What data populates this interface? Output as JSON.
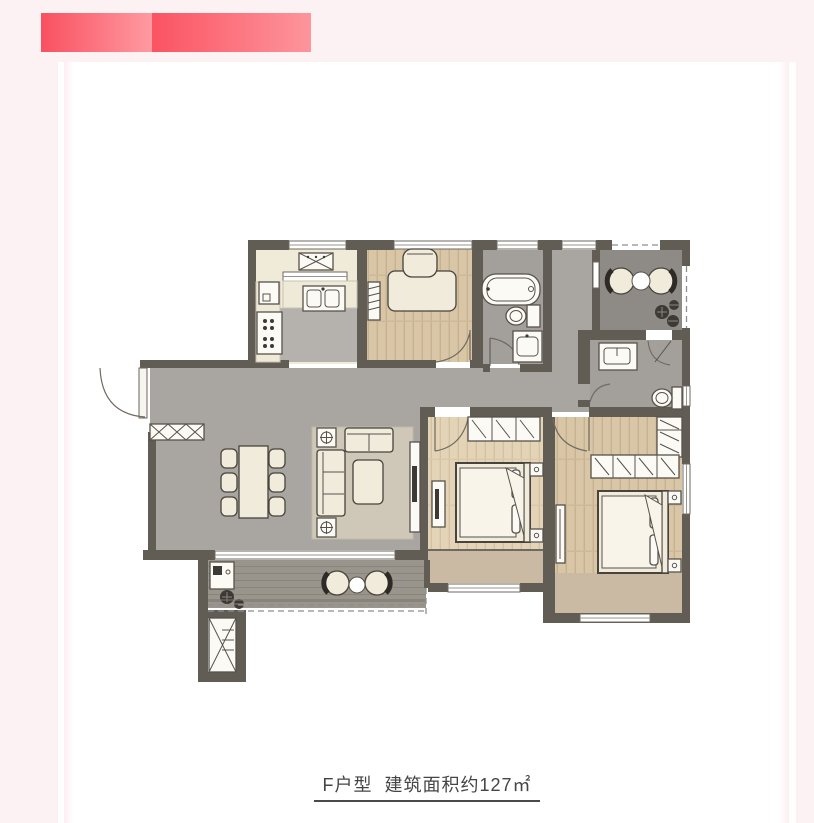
{
  "page": {
    "background": "#fdf2f3",
    "card_background": "#ffffff"
  },
  "header_bars": {
    "bar1": {
      "gradient_start": "#fa5060",
      "gradient_end": "#fe9aa1"
    },
    "bar2": {
      "gradient_start": "#fb5362",
      "gradient_end": "#fd959c"
    }
  },
  "floorplan": {
    "caption": "F户型  建筑面积约127㎡",
    "unit_label": "F户型",
    "area_label": "建筑面积约127㎡",
    "palette": {
      "wall": "#615c54",
      "tile": "#a9a6a2",
      "bath": "#a3a09c",
      "terrace": "#8e8b86",
      "balcony": "#99948c",
      "sill": "#cbbaa3",
      "furn": "#f1ebdc",
      "furnst": "#48433c",
      "rug": "#cfc8b9",
      "wood": "#d8c6a7",
      "wood_light": "#e4d4b7"
    }
  }
}
